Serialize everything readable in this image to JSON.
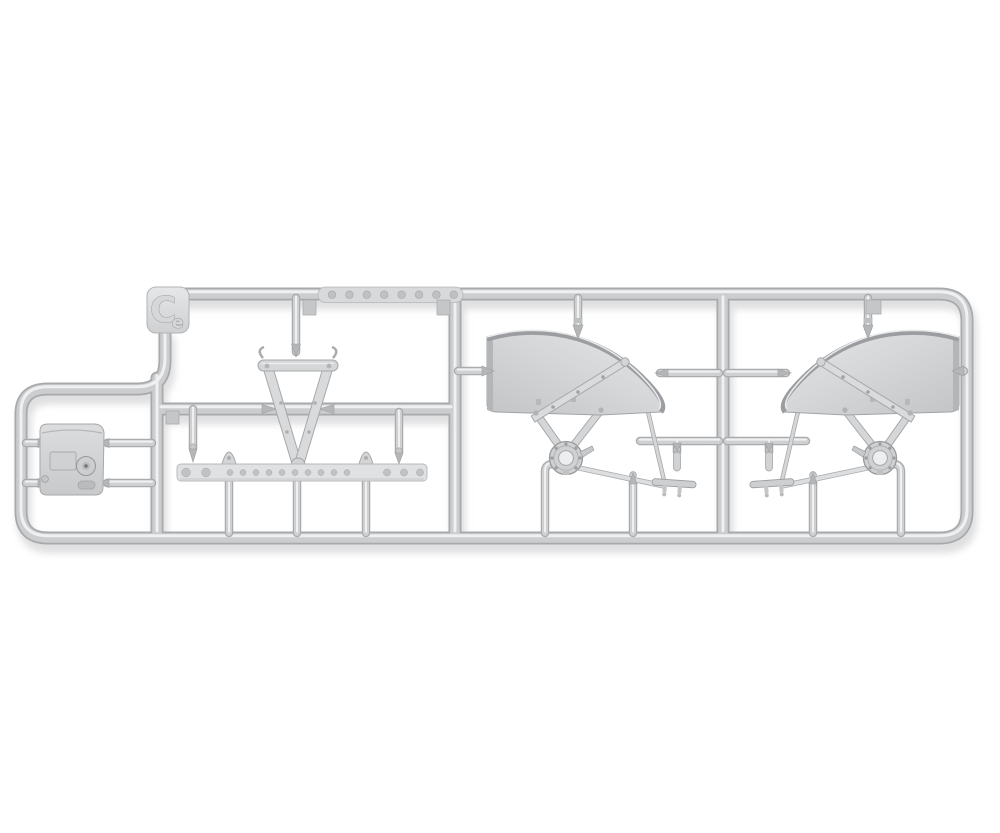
{
  "photo": {
    "subject": "plastic model kit sprue",
    "description": "Light grey injection-moulded sprue (runner frame) photographed on white, holding unassembled model parts: two mirrored curved fender assemblies with support struts, hub rings and tie rods, a V-shaped tow-bar frame with hooked ends, a long drilled flat strip, a small equipment box with a round latch, and assorted small rods on gates.",
    "background_color": "#ffffff",
    "plastic_color": "#cbcdcf",
    "plastic_highlight": "#eef0f1",
    "plastic_shadow": "#a7a9ab",
    "fender_face_color": "#d4d5d7",
    "fender_rim_color": "#9b9da0"
  },
  "sprue": {
    "tag_letter": "C",
    "material_mark": "e",
    "top_strip_holes": 8,
    "drilled_strip_holes": 15,
    "parts": [
      {
        "name": "equipment-box",
        "description": "small box with recessed panel and round latch",
        "section": "left"
      },
      {
        "name": "tow-bar-frame",
        "description": "V-shaped frame, hooked ends, bolted apex",
        "section": "middle"
      },
      {
        "name": "drilled-strip",
        "description": "long flat strip pierced with holes, two clip tabs",
        "section": "middle"
      },
      {
        "name": "fender-assembly",
        "description": "curved fender with face strut, A-struts, flanged hub ring, tie rods and bracket",
        "section": "center",
        "count": 2
      },
      {
        "name": "small-rods",
        "description": "short cylindrical rods and levers on gates",
        "count": 6
      }
    ]
  }
}
